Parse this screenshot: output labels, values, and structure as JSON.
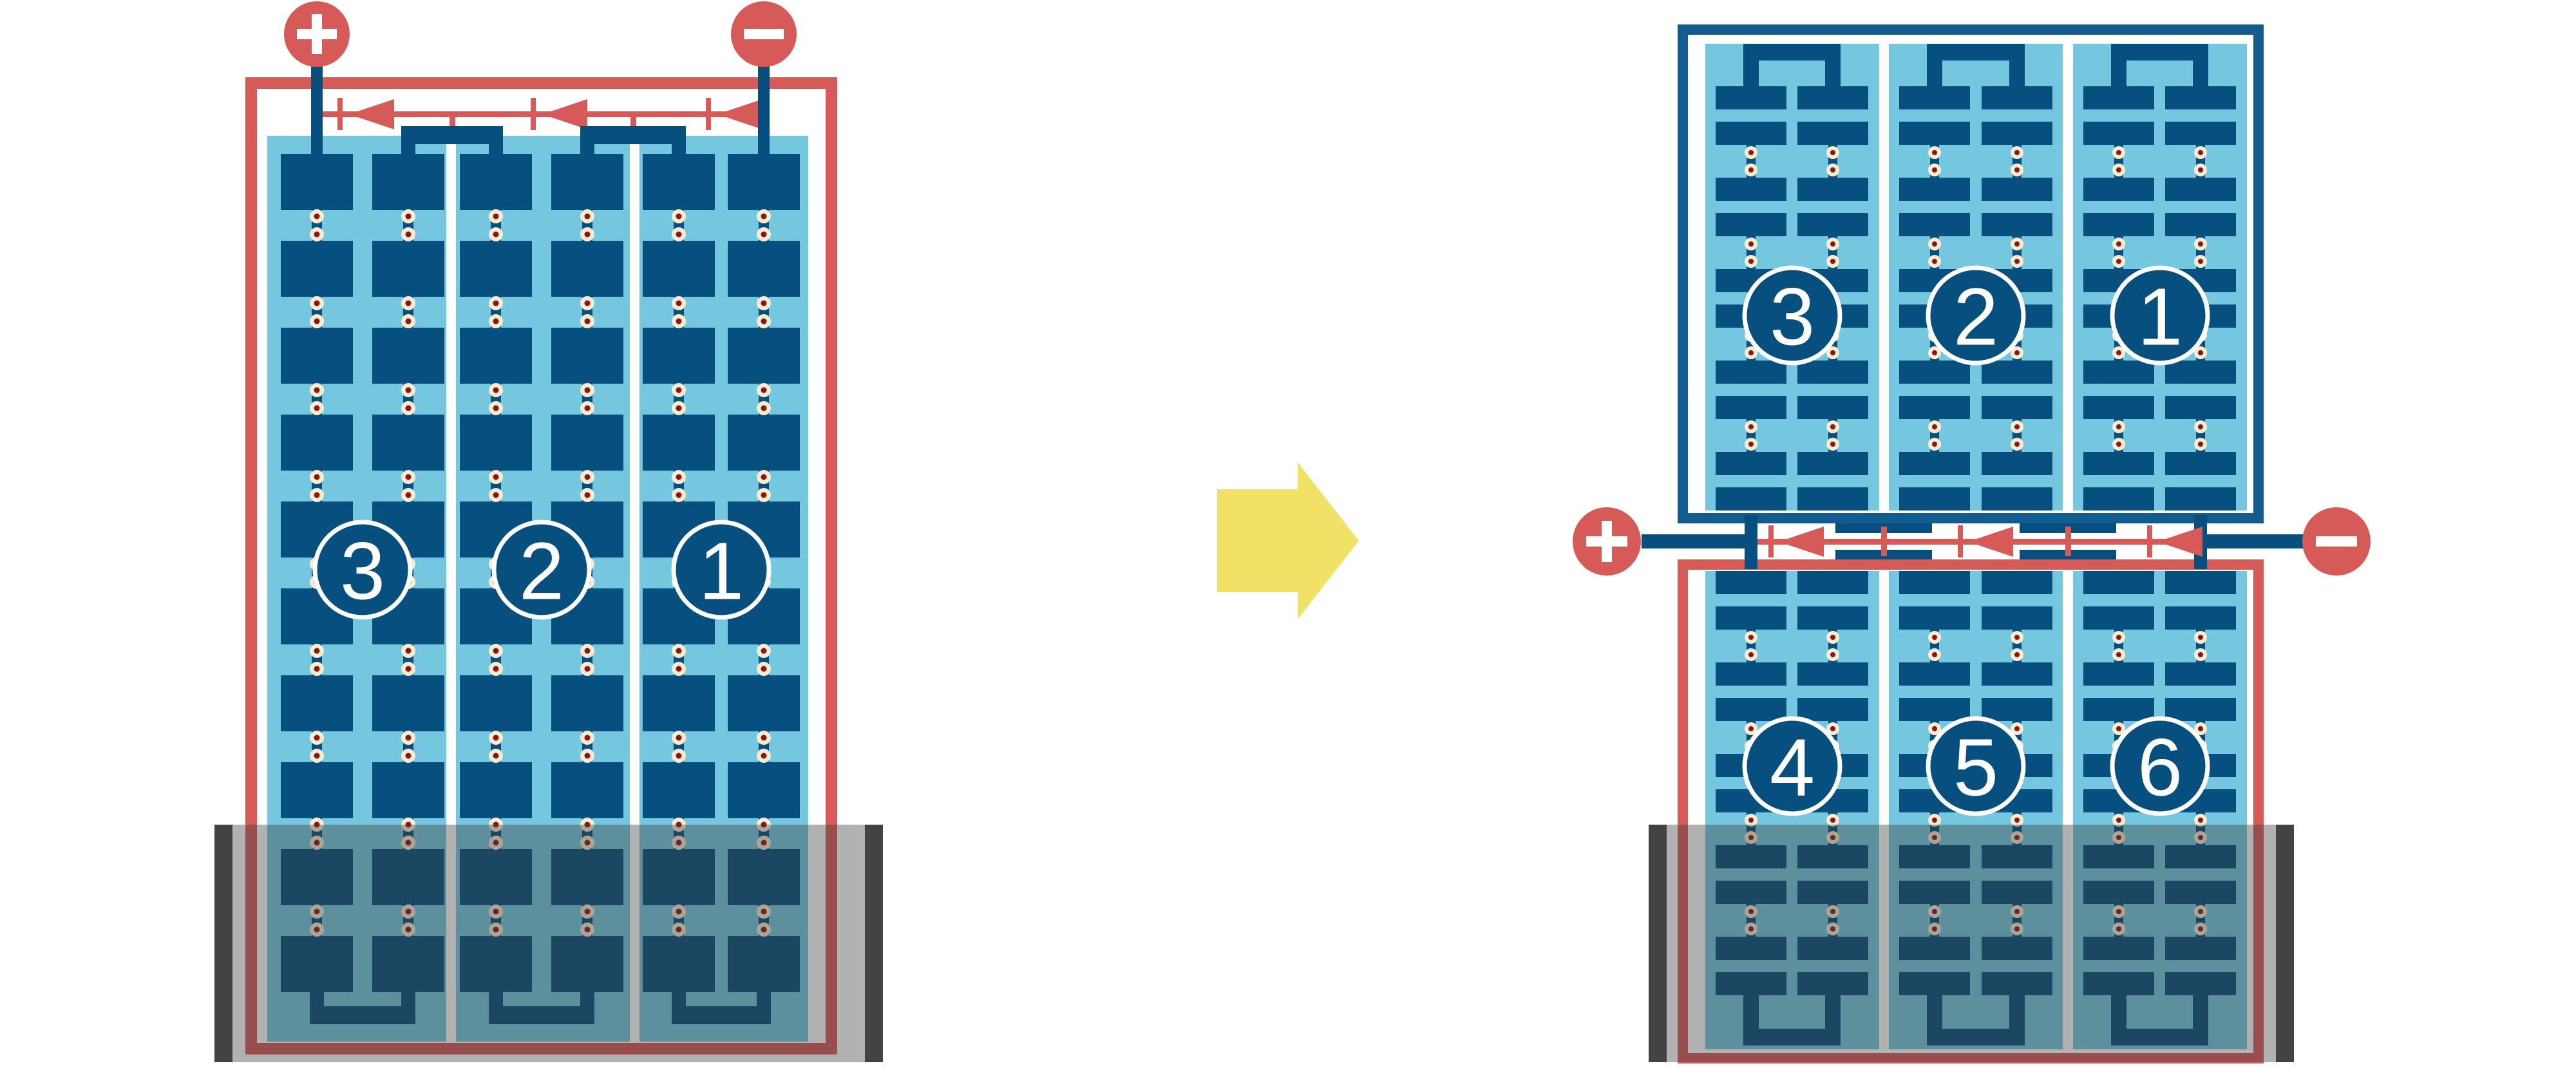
{
  "colors": {
    "red": "#D65A57",
    "dark_blue": "#074F7E",
    "frame_blue": "#135C90",
    "light_blue": "#74C7DE",
    "cream": "#F6ECD2",
    "dot_red": "#8C1616",
    "yellow": "#F2E167",
    "shade": "rgba(60,60,60,0.40)",
    "shade_bar": "#3A3A3A",
    "label_text": "#FFFFFF"
  },
  "left_module": {
    "string_labels": [
      "3",
      "2",
      "1"
    ],
    "positive_terminal": "+",
    "negative_terminal": "−",
    "bypass_diode_count": 3,
    "shaded_region": "bottom"
  },
  "transform_arrow": {
    "icon": "arrow-right-icon"
  },
  "right_top_module": {
    "string_labels": [
      "3",
      "2",
      "1"
    ]
  },
  "right_junction": {
    "positive_terminal": "+",
    "negative_terminal": "−",
    "bypass_diode_count": 3
  },
  "right_bottom_module": {
    "string_labels": [
      "4",
      "5",
      "6"
    ],
    "shaded_region": "bottom"
  },
  "icons": {
    "positive": "plus-icon",
    "negative": "minus-icon",
    "diode": "diode-left-icon",
    "arrow": "arrow-right-icon"
  }
}
